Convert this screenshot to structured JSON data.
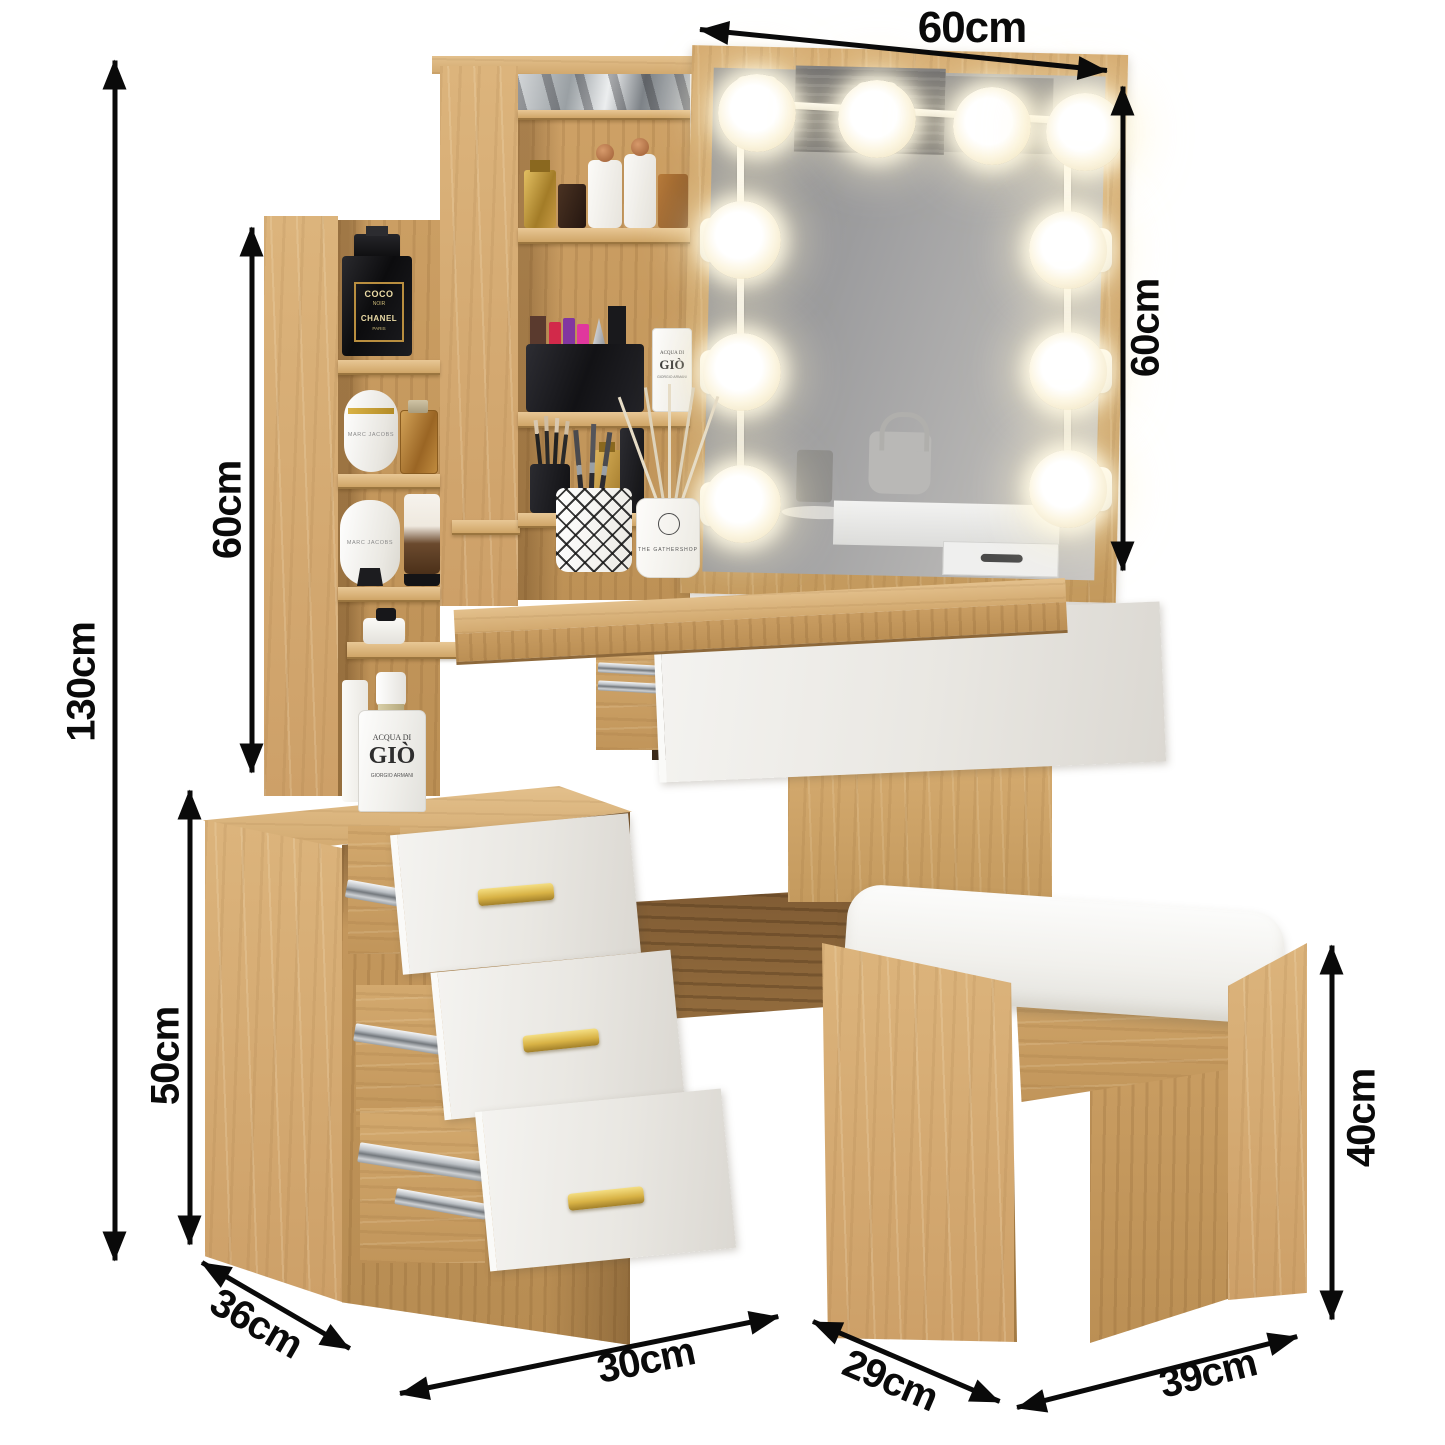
{
  "image_type": "furniture dimension diagram",
  "scene": {
    "background": "#ffffff"
  },
  "dims": {
    "mirror_width": "60cm",
    "mirror_height": "60cm",
    "total_height": "130cm",
    "side_shelf_height": "60cm",
    "cabinet_height": "50cm",
    "cabinet_depth": "36cm",
    "drawer_width": "30cm",
    "stool_width": "29cm",
    "stool_depth": "39cm",
    "stool_height": "40cm"
  },
  "products": {
    "chanel_coco": {
      "line1": "COCO",
      "line2": "NOIR",
      "line3": "CHANEL",
      "line4": "PARIS"
    },
    "marc_jacobs_upper": "MARC JACOBS",
    "marc_jacobs_lower": "MARC JACOBS",
    "acqua_di_gio_shelf": {
      "line1": "ACQUA DI",
      "line2": "GIÒ",
      "line3": "GIORGIO ARMANI"
    },
    "acqua_di_gio_large": {
      "line1": "ACQUA DI",
      "line2": "GIÒ",
      "line3": "GIORGIO ARMANI"
    },
    "reed_diffuser": "THE GATHERSHOP"
  },
  "colors": {
    "arrow": "#0a0a0a",
    "wood": "#cda269",
    "wood_light": "#ddb887",
    "wood_dark": "#7c5833",
    "drawer_white": "#eceae6",
    "handle_gold": "#d8b245",
    "chrome": "#aeb3b8",
    "mirror_glass": "#a3a2a1",
    "bulb_glow": "#fff6d8",
    "cushion_white": "#f4f3f0"
  }
}
